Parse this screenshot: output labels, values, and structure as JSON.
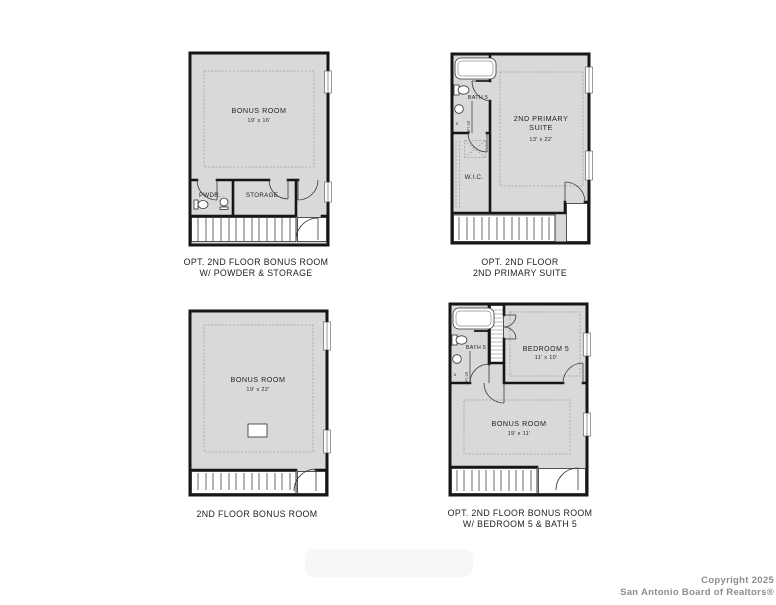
{
  "colors": {
    "floor_fill": "#d9d9d9",
    "wall": "#161616",
    "caption_text": "#222222",
    "copyright_text": "#8d8d8d",
    "watermark_fill": "#f7f7f7"
  },
  "copyright": {
    "line1": "Copyright 2025",
    "line2": "San Antonio Board of Realtors®"
  },
  "plans": {
    "tl": {
      "caption": [
        "OPT. 2ND FLOOR BONUS ROOM",
        "W/ POWDER & STORAGE"
      ],
      "bonus_name": "BONUS ROOM",
      "bonus_dims": "19' x 16'",
      "powder_label": "PWDR.",
      "storage_label": "STORAGE"
    },
    "tr": {
      "caption": [
        "OPT. 2ND FLOOR",
        "2ND PRIMARY SUITE"
      ],
      "suite_name_1": "2ND PRIMARY",
      "suite_name_2": "SUITE",
      "suite_dims": "13' x 22'",
      "bath_label": "BATH 5",
      "wic_label": "W.I.C.",
      "toilet_num": "5",
      "opt_label": "OPT. DR"
    },
    "bl": {
      "caption": [
        "2ND FLOOR BONUS ROOM"
      ],
      "bonus_name": "BONUS ROOM",
      "bonus_dims": "19' x 22'"
    },
    "br": {
      "caption": [
        "OPT. 2ND FLOOR BONUS ROOM",
        "W/ BEDROOM 5 & BATH 5"
      ],
      "bedroom_name": "BEDROOM 5",
      "bedroom_dims": "11' x 10'",
      "bonus_name": "BONUS ROOM",
      "bonus_dims": "19' x 11'",
      "bath_label": "BATH 5",
      "toilet_num": "5",
      "opt_label": "OPT. DR"
    }
  }
}
